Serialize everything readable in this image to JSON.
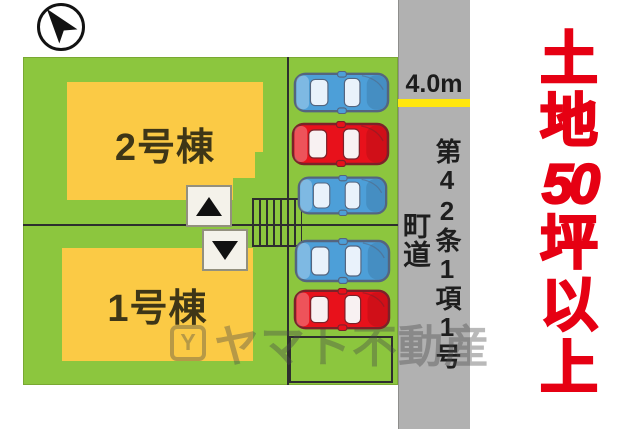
{
  "meta": {
    "type": "property-plot-plan"
  },
  "compass": {
    "name": "north-arrow"
  },
  "site": {
    "buildings": [
      {
        "label": "2号棟"
      },
      {
        "label": "1号棟"
      }
    ],
    "lawn_color": "#8cc63e",
    "building_color": "#fbca45"
  },
  "parking": {
    "cars": [
      {
        "color": "blue",
        "x": 293,
        "y": 71,
        "w": 97,
        "h": 43
      },
      {
        "color": "red",
        "x": 291,
        "y": 121,
        "w": 99,
        "h": 46
      },
      {
        "color": "blue",
        "x": 297,
        "y": 175,
        "w": 91,
        "h": 41
      },
      {
        "color": "blue",
        "x": 294,
        "y": 238,
        "w": 97,
        "h": 46
      },
      {
        "color": "red",
        "x": 293,
        "y": 288,
        "w": 98,
        "h": 43
      }
    ],
    "car_colors": {
      "blue": {
        "body": "#4d9fd8",
        "window": "#e9f2fb",
        "outline": "#54657f"
      },
      "red": {
        "body": "#e8111b",
        "window": "#f8f1f2",
        "outline": "#7c2129"
      }
    }
  },
  "road": {
    "width_label": "4.0m",
    "designation": "第42条1項1号",
    "road_type": "町道",
    "surface_color": "#b1b1b1",
    "width_marker_color": "#ffe70d"
  },
  "headline": {
    "text": "土地50坪以上",
    "lines": [
      "土",
      "地",
      "50",
      "坪",
      "以",
      "上"
    ],
    "color": "#e60013"
  },
  "watermark": {
    "icon_letter": "Y",
    "text": "ヤマト不動産"
  }
}
